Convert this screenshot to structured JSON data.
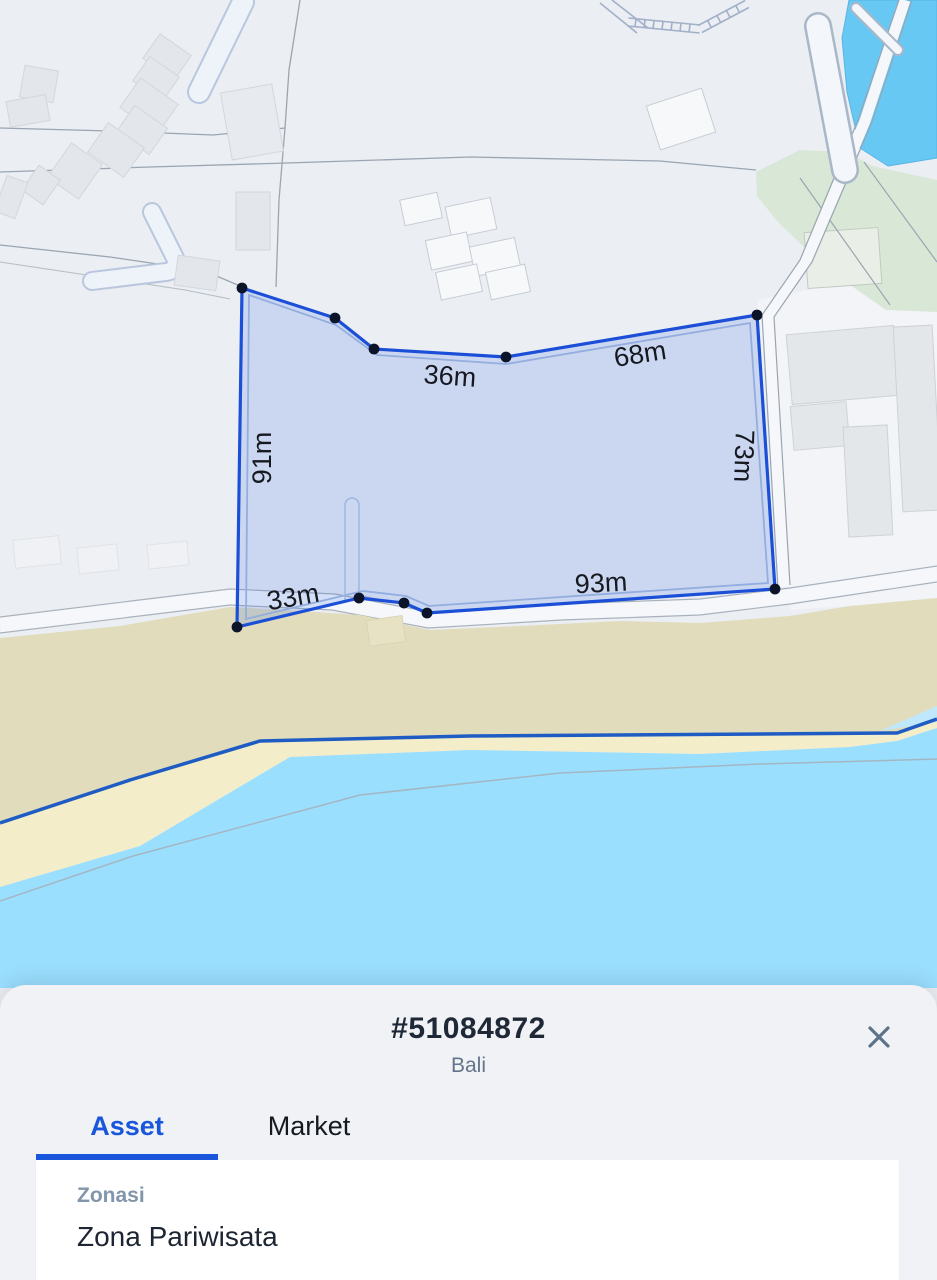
{
  "map": {
    "measurements": [
      {
        "edge": "top-left-edge",
        "text": "36m"
      },
      {
        "edge": "top-right-edge",
        "text": "68m"
      },
      {
        "edge": "left-edge",
        "text": "91m"
      },
      {
        "edge": "right-edge",
        "text": "73m"
      },
      {
        "edge": "bottom-left-edge",
        "text": "33m"
      },
      {
        "edge": "bottom-edge",
        "text": "93m"
      }
    ],
    "colors": {
      "land": "#ebeef2",
      "parcel_fill": "rgba(37,99,235,0.16)",
      "parcel_stroke": "#1b4fd7",
      "vertex_dot": "#0b1428",
      "ocean": "#9bdfff",
      "sand_dark": "#e1dcbc",
      "sand_light": "#f4edca",
      "coast_line": "#1e5cc4",
      "pond": "#67c8f3",
      "green_area": "#d9e7d6"
    }
  },
  "sheet": {
    "parcel_id": "#51084872",
    "region": "Bali",
    "close_icon": "close-icon",
    "accent": "#1a56db",
    "tabs": [
      {
        "label": "Asset",
        "active": true
      },
      {
        "label": "Market",
        "active": false
      }
    ],
    "fields": [
      {
        "label": "Zonasi",
        "value": "Zona Pariwisata"
      }
    ]
  }
}
